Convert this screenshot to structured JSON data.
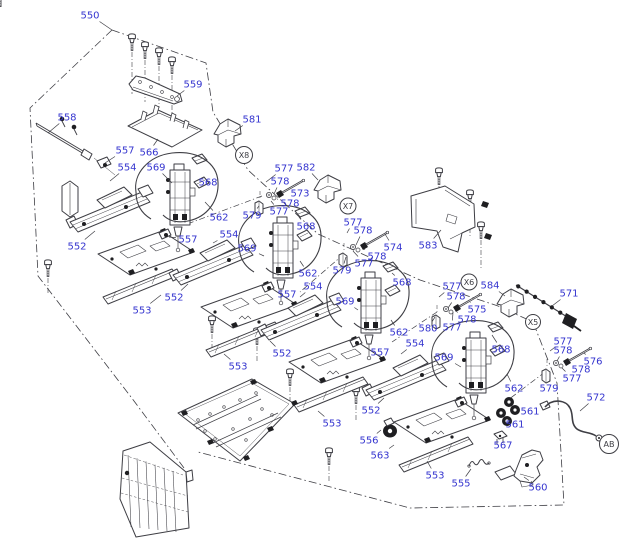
{
  "diagram": {
    "kind": "exploded-parts-diagram",
    "background": "#ffffff",
    "label_color": "#3535cf",
    "line_color": "#3e3e44",
    "dark_fill": "#1f1f22"
  },
  "callout_circles": [
    [
      "X8",
      244,
      155,
      8.5
    ],
    [
      "X7",
      348,
      206,
      8
    ],
    [
      "X6",
      469,
      282,
      8
    ],
    [
      "X5",
      533,
      322,
      7.5
    ],
    [
      "AB",
      609,
      444,
      9.5
    ]
  ],
  "part_labels": [
    [
      "550",
      90,
      15,
      112,
      30
    ],
    [
      "559",
      193,
      84,
      177,
      96
    ],
    [
      "558",
      67,
      117,
      48,
      133
    ],
    [
      "557",
      125,
      150,
      105,
      163
    ],
    [
      "566",
      149,
      152,
      158,
      139
    ],
    [
      "554",
      127,
      167,
      110,
      181
    ],
    [
      "569",
      156,
      167,
      172,
      183
    ],
    [
      "581",
      252,
      119,
      235,
      131
    ],
    [
      "568",
      208,
      182,
      200,
      176
    ],
    [
      "562",
      219,
      217,
      205,
      202
    ],
    [
      "552",
      77,
      246,
      95,
      231
    ],
    [
      "553",
      142,
      310,
      161,
      295
    ],
    [
      "557",
      188,
      239,
      169,
      237
    ],
    [
      "577",
      284,
      168,
      266,
      182
    ],
    [
      "582",
      306,
      167,
      318,
      180
    ],
    [
      "578",
      280,
      181,
      274,
      194
    ],
    [
      "573",
      300,
      193,
      293,
      187
    ],
    [
      "578",
      290,
      203,
      277,
      199
    ],
    [
      "577",
      279,
      211,
      271,
      201
    ],
    [
      "579",
      252,
      215,
      259,
      206
    ],
    [
      "577",
      353,
      222,
      347,
      233
    ],
    [
      "578",
      363,
      230,
      356,
      245
    ],
    [
      "574",
      393,
      247,
      385,
      234
    ],
    [
      "578",
      377,
      256,
      364,
      249
    ],
    [
      "577",
      364,
      263,
      353,
      251
    ],
    [
      "579",
      342,
      270,
      346,
      257
    ],
    [
      "583",
      428,
      245,
      441,
      230
    ],
    [
      "584",
      490,
      285,
      505,
      296
    ],
    [
      "571",
      569,
      293,
      552,
      306
    ],
    [
      "577",
      452,
      286,
      439,
      297
    ],
    [
      "578",
      456,
      296,
      448,
      308
    ],
    [
      "575",
      477,
      309,
      470,
      302
    ],
    [
      "578",
      467,
      319,
      457,
      312
    ],
    [
      "577",
      452,
      327,
      453,
      312
    ],
    [
      "580",
      428,
      328,
      435,
      317
    ],
    [
      "554",
      229,
      234,
      213,
      243
    ],
    [
      "569",
      247,
      248,
      264,
      256
    ],
    [
      "557",
      287,
      294,
      277,
      290
    ],
    [
      "568",
      306,
      226,
      299,
      217
    ],
    [
      "562",
      308,
      273,
      300,
      261
    ],
    [
      "552",
      174,
      297,
      188,
      284
    ],
    [
      "553",
      238,
      366,
      224,
      354
    ],
    [
      "554",
      313,
      286,
      300,
      297
    ],
    [
      "569",
      345,
      301,
      358,
      310
    ],
    [
      "557",
      380,
      352,
      367,
      348
    ],
    [
      "568",
      402,
      282,
      392,
      273
    ],
    [
      "562",
      399,
      332,
      391,
      320
    ],
    [
      "552",
      282,
      353,
      270,
      341
    ],
    [
      "553",
      332,
      423,
      318,
      411
    ],
    [
      "554",
      415,
      343,
      401,
      354
    ],
    [
      "569",
      444,
      357,
      461,
      367
    ],
    [
      "568",
      501,
      349,
      492,
      335
    ],
    [
      "562",
      514,
      388,
      507,
      374
    ],
    [
      "552",
      371,
      410,
      384,
      398
    ],
    [
      "553",
      435,
      475,
      427,
      461
    ],
    [
      "577",
      563,
      341,
      550,
      351
    ],
    [
      "578",
      563,
      350,
      557,
      361
    ],
    [
      "576",
      593,
      361,
      584,
      353
    ],
    [
      "578",
      581,
      369,
      571,
      364
    ],
    [
      "577",
      572,
      378,
      562,
      368
    ],
    [
      "579",
      549,
      388,
      550,
      377
    ],
    [
      "561",
      530,
      411,
      519,
      407
    ],
    [
      "561",
      515,
      424,
      508,
      419
    ],
    [
      "567",
      503,
      445,
      500,
      440
    ],
    [
      "572",
      596,
      397,
      580,
      411
    ],
    [
      "560",
      538,
      487,
      524,
      477
    ],
    [
      "555",
      461,
      483,
      471,
      469
    ],
    [
      "556",
      369,
      440,
      381,
      430
    ],
    [
      "563",
      380,
      455,
      394,
      445
    ]
  ],
  "boundaries": {
    "outline_left": [
      [
        112,
        30
      ],
      [
        30,
        108
      ],
      [
        38,
        276
      ],
      [
        131,
        397
      ],
      [
        184,
        468
      ]
    ],
    "outline_right": [
      [
        112,
        30
      ],
      [
        206,
        63
      ],
      [
        213,
        112
      ],
      [
        248,
        170
      ],
      [
        318,
        234
      ],
      [
        420,
        280
      ],
      [
        498,
        306
      ],
      [
        533,
        322
      ],
      [
        557,
        383
      ],
      [
        564,
        505
      ],
      [
        410,
        508
      ],
      [
        198,
        452
      ]
    ],
    "align_lines": [
      [
        [
          262,
          196
        ],
        [
          182,
          226
        ]
      ],
      [
        [
          344,
          254
        ],
        [
          300,
          292
        ]
      ],
      [
        [
          437,
          312
        ],
        [
          392,
          342
        ]
      ],
      [
        [
          545,
          372
        ],
        [
          508,
          400
        ]
      ]
    ]
  },
  "units": [
    [
      170,
      170
    ],
    [
      273,
      223
    ],
    [
      361,
      278
    ],
    [
      466,
      338
    ]
  ],
  "fastener_clusters": [
    [
      260,
      184
    ],
    [
      344,
      236
    ],
    [
      437,
      298
    ],
    [
      547,
      352
    ]
  ],
  "screws": [
    [
      132,
      44
    ],
    [
      145,
      52
    ],
    [
      159,
      58
    ],
    [
      172,
      67
    ],
    [
      48,
      270
    ],
    [
      212,
      326
    ],
    [
      257,
      338
    ],
    [
      290,
      379
    ],
    [
      356,
      397
    ],
    [
      329,
      458
    ],
    [
      439,
      178
    ],
    [
      470,
      200
    ],
    [
      481,
      232
    ]
  ]
}
